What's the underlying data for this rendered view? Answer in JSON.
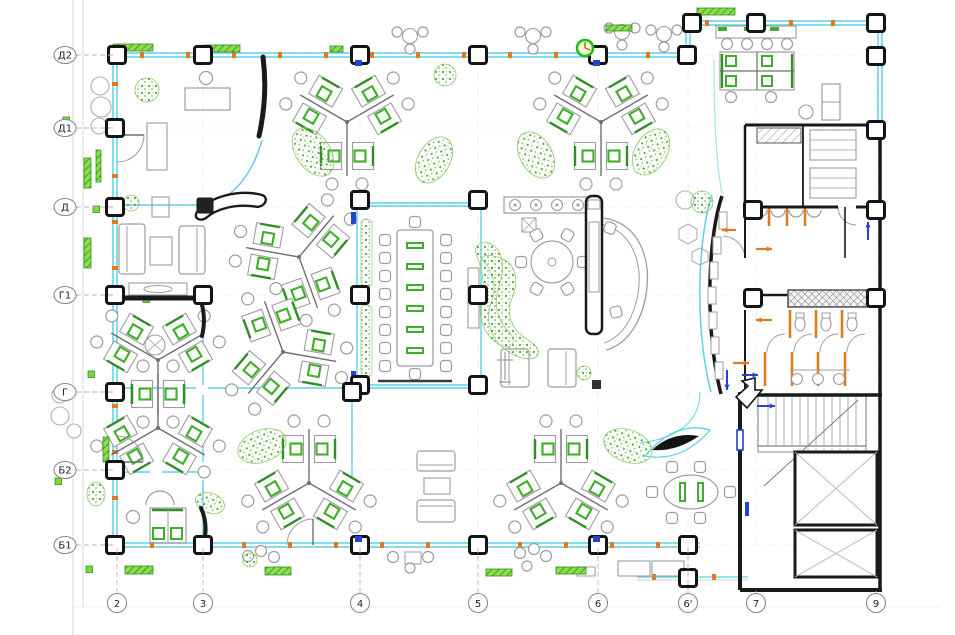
{
  "drawing": {
    "kind": "office floor plan",
    "grid": {
      "rows": [
        {
          "label": "Д2",
          "y": 55
        },
        {
          "label": "Д1",
          "y": 128
        },
        {
          "label": "Д",
          "y": 207
        },
        {
          "label": "Г1",
          "y": 295
        },
        {
          "label": "Г",
          "y": 392
        },
        {
          "label": "Б2",
          "y": 470
        },
        {
          "label": "Б1",
          "y": 545
        }
      ],
      "cols": [
        {
          "label": "2",
          "x": 117
        },
        {
          "label": "3",
          "x": 203
        },
        {
          "label": "4",
          "x": 360
        },
        {
          "label": "5",
          "x": 478
        },
        {
          "label": "6",
          "x": 598
        },
        {
          "label": "6'",
          "x": 688
        },
        {
          "label": "7",
          "x": 756
        },
        {
          "label": "9",
          "x": 876
        }
      ]
    },
    "symbols": [
      "structural-column",
      "curtain-wall-glazing",
      "door-swing",
      "clock-symbol",
      "exit-arrow",
      "staircase",
      "elevator-shaft",
      "toilet-stall-partition",
      "desk-cluster",
      "plant",
      "vent-grille"
    ]
  },
  "colors": {
    "background": "#ffffff",
    "wall": "#1a1a1a",
    "glazing": "#5ad2ea",
    "glazing_soft": "#9fe6f2",
    "furniture": "#9d9d9d",
    "furniture_dark": "#707070",
    "green": "#3fae2a",
    "green_dark": "#2f8f25",
    "foliage": "#5cb03c",
    "foliage_light": "#8ccb6a",
    "vent": "#7ed932",
    "orange": "#e07a1e",
    "blue": "#2543cc",
    "axis_line": "#b5b5b5",
    "axis_text": "#222222",
    "frame": "#d9d9d9",
    "dash": "#dcdcdc"
  }
}
